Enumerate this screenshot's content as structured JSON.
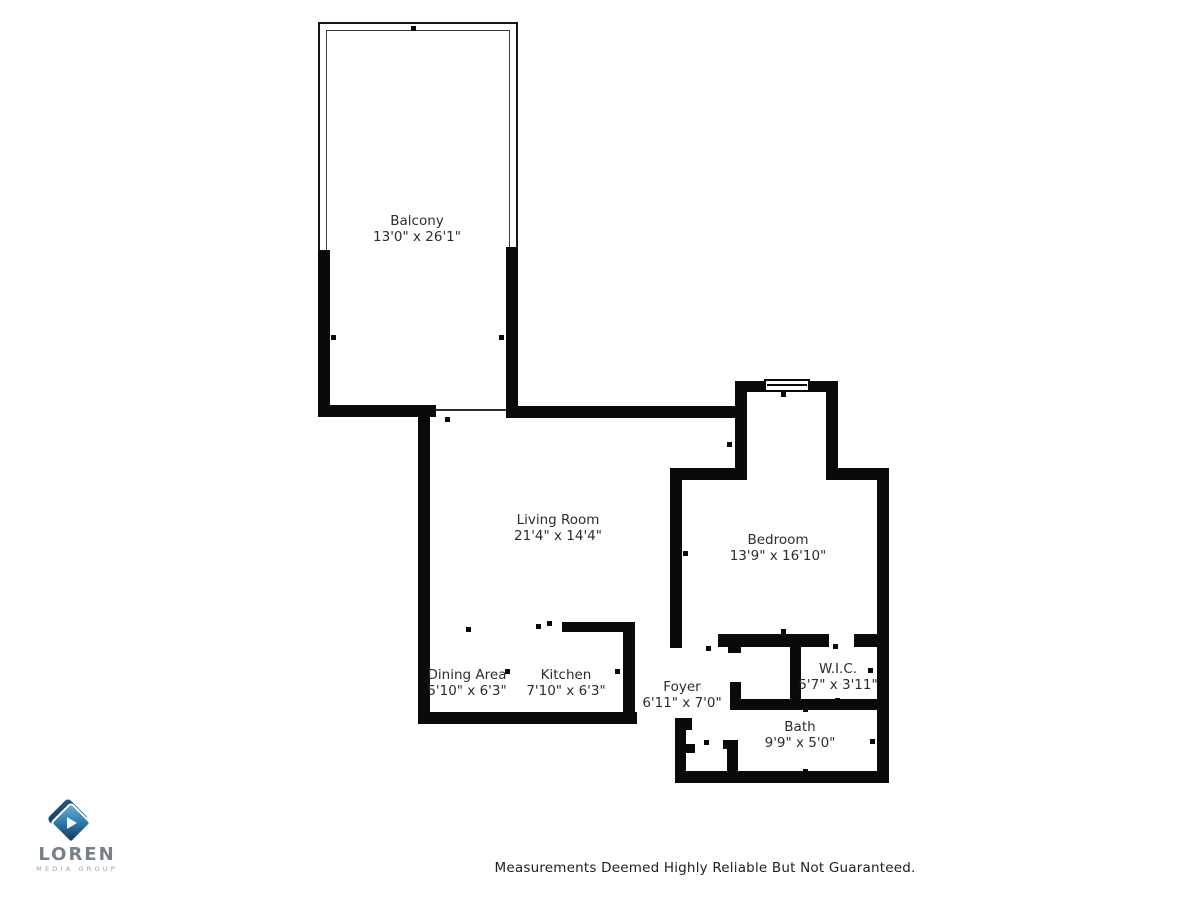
{
  "page": {
    "disclaimer": "Measurements Deemed Highly Reliable But Not Guaranteed."
  },
  "logo": {
    "name": "LOREN",
    "subtitle": "MEDIA GROUP",
    "icon": "play-diamond-icon"
  },
  "floor_plan": {
    "rooms": [
      {
        "name": "Balcony",
        "dimensions": "13'0\" x 26'1\""
      },
      {
        "name": "Living Room",
        "dimensions": "21'4\" x 14'4\""
      },
      {
        "name": "Bedroom",
        "dimensions": "13'9\" x 16'10\""
      },
      {
        "name": "Dining Area",
        "dimensions": "5'10\" x 6'3\""
      },
      {
        "name": "Kitchen",
        "dimensions": "7'10\" x 6'3\""
      },
      {
        "name": "Foyer",
        "dimensions": "6'11\" x 7'0\""
      },
      {
        "name": "W.I.C.",
        "dimensions": "5'7\" x 3'11\""
      },
      {
        "name": "Bath",
        "dimensions": "9'9\" x 5'0\""
      }
    ]
  },
  "colors": {
    "wall": "#0a0a0a",
    "label-text": "#2d2d2d",
    "logo-text": "#76808b",
    "logo-subtext": "#98a1a9",
    "logo-blue-light": "#63b1dc",
    "logo-blue-dark": "#0e3557"
  }
}
